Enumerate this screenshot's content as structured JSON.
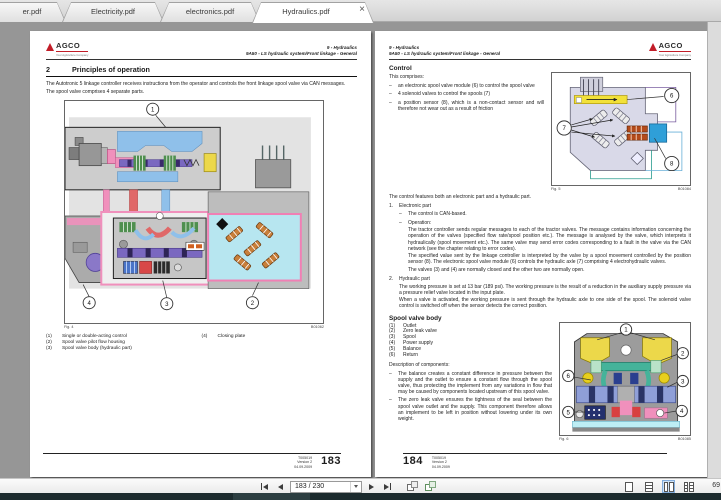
{
  "glyphs": {
    "dash": "–",
    "close": "×"
  },
  "brand": {
    "name": "AGCO",
    "tagline": "Your Agriculture Company"
  },
  "window": {
    "tabs": [
      {
        "label": "er.pdf",
        "active": false
      },
      {
        "label": "Electricity.pdf",
        "active": false
      },
      {
        "label": "electronics.pdf",
        "active": false
      },
      {
        "label": "Hydraulics.pdf",
        "active": true
      }
    ]
  },
  "toolbar": {
    "page_field": "183 / 230",
    "zoom_text": "69"
  },
  "colors": {
    "agco_red": "#c21d28",
    "canvas_gray": "#969696",
    "taskbar": "#1c2b2e",
    "selected_view_bg": "#cfe3f7",
    "diagram_yellow": "#ecd84a",
    "diagram_blue": "#8fc0ea",
    "diagram_pink": "#f090bc",
    "diagram_red": "#e06868",
    "diagram_purple": "#7a68c0",
    "diagram_cyan": "#b7e6f0",
    "diagram_orange": "#c87f3a",
    "diagram_teal": "#45b39a",
    "module_blue": "#2f9fd8",
    "highlight_yellow": "#f2e139"
  },
  "left_page": {
    "header": {
      "chapter": "9 - Hydraulics",
      "section": "9A50 - LS hydraulic system/Front linkage - General"
    },
    "section_number": "2",
    "section_title": "Principles of operation",
    "para1": "The Autotronic 5 linkage controller receives instructions from the operator and controls the front linkage spool valve via CAN messages.",
    "para2": "The spool valve comprises 4 separate parts.",
    "fig4": {
      "label": "Fig. 4",
      "ref": "B01062",
      "callouts": [
        "1",
        "2",
        "3",
        "4"
      ]
    },
    "captions": [
      {
        "num": "(1)",
        "text": "Single or double-acting control"
      },
      {
        "num": "(2)",
        "text": "Spool valve pilot flow housing"
      },
      {
        "num": "(3)",
        "text": "Spool valve body (hydraulic part)"
      },
      {
        "num": "(4)",
        "text": "Closing plate"
      }
    ],
    "footer": {
      "doc": "T005019",
      "version": "Version 2",
      "date": "04.09.2009",
      "page": "183"
    }
  },
  "right_page": {
    "header": {
      "chapter": "9 - Hydraulics",
      "section": "9A50 - LS hydraulic system/Front linkage - General"
    },
    "control_heading": "Control",
    "comprises_intro": "This comprises:",
    "bullets": [
      "an electronic spool valve module (6) to control the spool valve",
      "4 solenoid valves to control the spools (7)",
      "a position sensor (8), which is a non-contact sensor and will therefore not wear out as a result of friction"
    ],
    "fig5": {
      "label": "Fig. 5",
      "ref": "B01084",
      "callouts": [
        "6",
        "7",
        "8"
      ]
    },
    "control_para": "The control features both an electronic part and a hydraulic part.",
    "item1_num": "1.",
    "item1_title": "Electronic part",
    "item1_b1": "The control is CAN-based.",
    "item1_b2_label": "Operation:",
    "item1_b2_p1": "The tractor controller sends regular messages to each of the tractor valves. The message contains information concerning the operation of the valves (specified flow rate/spool position etc.). The message is analysed by the valve, which interprets it hydraulically (spool movement etc.). The same valve may send error codes corresponding to a fault in the valve via the CAN network (see the chapter relating to error codes).",
    "item1_b2_p2": "The specified value sent by the linkage controller is interpreted by the valve by a spool movement controlled by the position sensor (8). The electronic spool valve module (6) controls the hydraulic axle (7) comprising 4 electrohydraulic valves.",
    "item1_b2_p3": "The valves (3) and (4) are normally closed and the other two are normally open.",
    "item2_num": "2.",
    "item2_title": "Hydraulic part",
    "item2_p1": "The working pressure is set at 13 bar (189 psi). The working pressure is the result of a reduction in the auxiliary supply pressure via a pressure relief valve located in the input plate.",
    "item2_p2": "When a valve is activated, the working pressure is sent through the hydraulic axle to one side of the spool. The solenoid valve control is switched off when the sensor detects the correct position.",
    "svb_heading": "Spool valve body",
    "svb_items": [
      {
        "num": "(1)",
        "text": "Outlet"
      },
      {
        "num": "(2)",
        "text": "Zero leak valve"
      },
      {
        "num": "(3)",
        "text": "Spool"
      },
      {
        "num": "(4)",
        "text": "Power supply"
      },
      {
        "num": "(5)",
        "text": "Balance"
      },
      {
        "num": "(6)",
        "text": "Return"
      }
    ],
    "desc_label": "Description of components:",
    "desc_b1": "The balance creates a constant difference in pressure between the supply and the outlet to ensure a constant flow through the spool valve, thus protecting the implement from any variations in flow that may be caused by components located upstream of this spool valve.",
    "desc_b2": "The zero leak valve ensures the tightness of the seal between the spool valve outlet and the supply. This component therefore allows an implement to be left in position without lowering under its own weight.",
    "fig6": {
      "label": "Fig. 6",
      "ref": "B01085",
      "callouts": [
        "1",
        "2",
        "3",
        "4",
        "5",
        "6"
      ]
    },
    "footer": {
      "page": "184",
      "doc": "T005019",
      "version": "Version 2",
      "date": "04.09.2009"
    }
  }
}
